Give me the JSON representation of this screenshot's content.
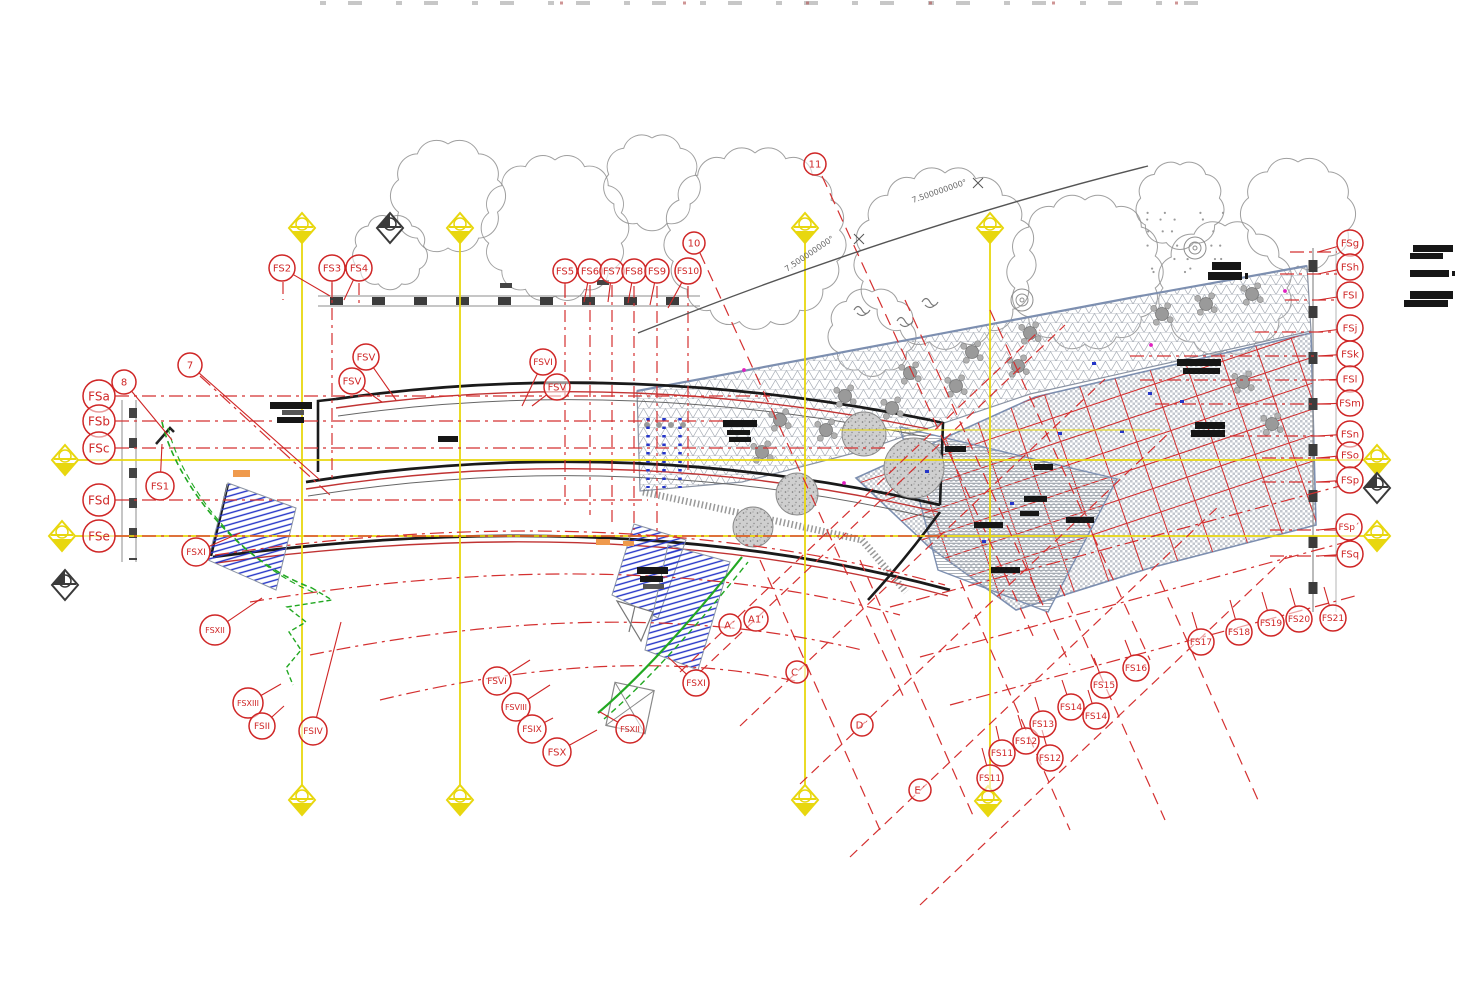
{
  "document": {
    "type_label": "architectural floor plan — grid and callout sheet"
  },
  "colors": {
    "red": "#d43030",
    "bubble": "#cf2626",
    "yellow": "#e8d70f",
    "yellow2": "#f5ea3a",
    "gray_line": "#8e8e8e",
    "green": "#22a822",
    "blue": "#2435c8",
    "orange": "#ef9a4d",
    "magenta": "#e020c0",
    "black": "#141414",
    "wall": "#1a1a1a"
  },
  "dimension_labels": [
    {
      "text": "7.500000000°",
      "x": 787,
      "y": 272,
      "rot": -34
    },
    {
      "text": "7.500000000°",
      "x": 913,
      "y": 203,
      "rot": -19
    }
  ],
  "callouts": [
    {
      "label": "FS2",
      "x": 282,
      "y": 268,
      "r": 13,
      "ax": 330,
      "ay": 296
    },
    {
      "label": "FS3",
      "x": 332,
      "y": 268,
      "r": 13,
      "ax": 332,
      "ay": 298
    },
    {
      "label": "FS4",
      "x": 359,
      "y": 268,
      "r": 13,
      "ax": 344,
      "ay": 300
    },
    {
      "label": "FS5",
      "x": 565,
      "y": 271,
      "r": 12,
      "ax": 565,
      "ay": 298
    },
    {
      "label": "FS6",
      "x": 590,
      "y": 271,
      "r": 12,
      "ax": 584,
      "ay": 302
    },
    {
      "label": "FS7",
      "x": 612,
      "y": 271,
      "r": 12,
      "ax": 608,
      "ay": 302
    },
    {
      "label": "FS8",
      "x": 634,
      "y": 271,
      "r": 12,
      "ax": 628,
      "ay": 303
    },
    {
      "label": "FS9",
      "x": 657,
      "y": 271,
      "r": 12,
      "ax": 650,
      "ay": 305
    },
    {
      "label": "FS10",
      "x": 688,
      "y": 271,
      "r": 13,
      "ax": 668,
      "ay": 308
    },
    {
      "label": "10",
      "x": 694,
      "y": 243,
      "r": 11
    },
    {
      "label": "11",
      "x": 815,
      "y": 164,
      "r": 11
    },
    {
      "label": "7",
      "x": 190,
      "y": 365,
      "r": 12,
      "ax": 320,
      "ay": 480
    },
    {
      "label": "8",
      "x": 124,
      "y": 382,
      "r": 12,
      "ax": 172,
      "ay": 440
    },
    {
      "label": "FSa",
      "x": 99,
      "y": 396,
      "r": 16,
      "ax": 115,
      "ay": 396
    },
    {
      "label": "FSb",
      "x": 99,
      "y": 421,
      "r": 16,
      "ax": 115,
      "ay": 421
    },
    {
      "label": "FSc",
      "x": 99,
      "y": 448,
      "r": 16,
      "ax": 115,
      "ay": 448
    },
    {
      "label": "FSd",
      "x": 99,
      "y": 500,
      "r": 16,
      "ax": 115,
      "ay": 500
    },
    {
      "label": "FSe",
      "x": 99,
      "y": 536,
      "r": 16,
      "ax": 115,
      "ay": 536
    },
    {
      "label": "FS1",
      "x": 160,
      "y": 486,
      "r": 14,
      "ax": 162,
      "ay": 444
    },
    {
      "label": "FSXI",
      "x": 196,
      "y": 552,
      "r": 14,
      "ax": 240,
      "ay": 533
    },
    {
      "label": "FSXII",
      "x": 215,
      "y": 630,
      "r": 15,
      "ax": 262,
      "ay": 598
    },
    {
      "label": "FSXIII",
      "x": 248,
      "y": 703,
      "r": 15,
      "ax": 281,
      "ay": 684
    },
    {
      "label": "FSII",
      "x": 262,
      "y": 726,
      "r": 13,
      "ax": 284,
      "ay": 706
    },
    {
      "label": "FSIV",
      "x": 313,
      "y": 731,
      "r": 14,
      "ax": 341,
      "ay": 622
    },
    {
      "label": "FSV",
      "x": 366,
      "y": 357,
      "r": 13,
      "ax": 396,
      "ay": 400
    },
    {
      "label": "FSV",
      "x": 352,
      "y": 381,
      "r": 13,
      "ax": 382,
      "ay": 402
    },
    {
      "label": "FSVI",
      "x": 543,
      "y": 362,
      "r": 13,
      "ax": 522,
      "ay": 406
    },
    {
      "label": "FSV",
      "x": 557,
      "y": 387,
      "r": 13,
      "ax": 532,
      "ay": 406
    },
    {
      "label": "FSVI",
      "x": 497,
      "y": 681,
      "r": 14,
      "ax": 530,
      "ay": 660
    },
    {
      "label": "FSVIII",
      "x": 516,
      "y": 707,
      "r": 14,
      "ax": 550,
      "ay": 685
    },
    {
      "label": "FSIX",
      "x": 532,
      "y": 729,
      "r": 14,
      "ax": 553,
      "ay": 718
    },
    {
      "label": "FSX",
      "x": 557,
      "y": 752,
      "r": 14,
      "ax": 597,
      "ay": 730
    },
    {
      "label": "FSXII",
      "x": 630,
      "y": 729,
      "r": 14,
      "ax": 600,
      "ay": 712
    },
    {
      "label": "FSXI",
      "x": 696,
      "y": 683,
      "r": 13,
      "ax": 668,
      "ay": 657
    },
    {
      "label": "FSg",
      "x": 1350,
      "y": 243,
      "r": 13,
      "ax": 1318,
      "ay": 252
    },
    {
      "label": "FSh",
      "x": 1350,
      "y": 267,
      "r": 13,
      "ax": 1318,
      "ay": 274
    },
    {
      "label": "FSI",
      "x": 1350,
      "y": 295,
      "r": 13,
      "ax": 1318,
      "ay": 300
    },
    {
      "label": "FSj",
      "x": 1350,
      "y": 328,
      "r": 13,
      "ax": 1318,
      "ay": 332
    },
    {
      "label": "FSk",
      "x": 1350,
      "y": 354,
      "r": 13,
      "ax": 1318,
      "ay": 356
    },
    {
      "label": "FSl",
      "x": 1350,
      "y": 379,
      "r": 13,
      "ax": 1318,
      "ay": 380
    },
    {
      "label": "FSm",
      "x": 1350,
      "y": 403,
      "r": 13,
      "ax": 1318,
      "ay": 404
    },
    {
      "label": "FSn",
      "x": 1350,
      "y": 434,
      "r": 13,
      "ax": 1318,
      "ay": 436
    },
    {
      "label": "FSo",
      "x": 1350,
      "y": 455,
      "r": 13,
      "ax": 1318,
      "ay": 458
    },
    {
      "label": "FSp",
      "x": 1350,
      "y": 480,
      "r": 13,
      "ax": 1318,
      "ay": 482
    },
    {
      "label": "FSp´",
      "x": 1349,
      "y": 527,
      "r": 13,
      "ax": 1318,
      "ay": 530
    },
    {
      "label": "FSq",
      "x": 1350,
      "y": 554,
      "r": 13,
      "ax": 1318,
      "ay": 556
    },
    {
      "label": "FS11",
      "x": 990,
      "y": 778,
      "r": 13,
      "ax": 982,
      "ay": 748
    },
    {
      "label": "FS11",
      "x": 1002,
      "y": 753,
      "r": 13,
      "ax": 996,
      "ay": 726
    },
    {
      "label": "FS12",
      "x": 1026,
      "y": 741,
      "r": 13,
      "ax": 1018,
      "ay": 715
    },
    {
      "label": "FS12",
      "x": 1050,
      "y": 758,
      "r": 13,
      "ax": 1042,
      "ay": 730
    },
    {
      "label": "FS13",
      "x": 1043,
      "y": 724,
      "r": 13,
      "ax": 1035,
      "ay": 697
    },
    {
      "label": "FS14",
      "x": 1071,
      "y": 707,
      "r": 13,
      "ax": 1062,
      "ay": 680
    },
    {
      "label": "FS14",
      "x": 1096,
      "y": 716,
      "r": 13,
      "ax": 1088,
      "ay": 690
    },
    {
      "label": "FS15",
      "x": 1104,
      "y": 685,
      "r": 13,
      "ax": 1094,
      "ay": 658
    },
    {
      "label": "FS16",
      "x": 1136,
      "y": 668,
      "r": 13,
      "ax": 1125,
      "ay": 640
    },
    {
      "label": "FS17",
      "x": 1201,
      "y": 642,
      "r": 13,
      "ax": 1192,
      "ay": 612
    },
    {
      "label": "FS18",
      "x": 1239,
      "y": 632,
      "r": 13,
      "ax": 1230,
      "ay": 600
    },
    {
      "label": "FS19",
      "x": 1271,
      "y": 623,
      "r": 13,
      "ax": 1262,
      "ay": 592
    },
    {
      "label": "FS20",
      "x": 1299,
      "y": 619,
      "r": 13,
      "ax": 1290,
      "ay": 588
    },
    {
      "label": "FS21",
      "x": 1333,
      "y": 618,
      "r": 13,
      "ax": 1324,
      "ay": 587
    },
    {
      "label": "A´",
      "x": 730,
      "y": 625,
      "r": 11
    },
    {
      "label": "A1'",
      "x": 756,
      "y": 619,
      "r": 12
    },
    {
      "label": "C´",
      "x": 797,
      "y": 672,
      "r": 11
    },
    {
      "label": "D´",
      "x": 862,
      "y": 725,
      "r": 11
    },
    {
      "label": "E´",
      "x": 920,
      "y": 790,
      "r": 11
    }
  ],
  "grid": {
    "yellow_vertical": [
      {
        "x": 302,
        "y1": 228,
        "y2": 800
      },
      {
        "x": 460,
        "y1": 228,
        "y2": 800
      },
      {
        "x": 805,
        "y1": 228,
        "y2": 800
      },
      {
        "x": 990,
        "y1": 228,
        "y2": 801
      }
    ],
    "yellow_horizontal": [
      {
        "y": 460,
        "x1": 65,
        "x2": 1377
      },
      {
        "y": 536,
        "x1": 62,
        "x2": 1377
      }
    ],
    "partial_horizontal": {
      "y": 430,
      "x1": 840,
      "x2": 1160
    },
    "markers_yellow": [
      [
        302,
        228
      ],
      [
        460,
        228
      ],
      [
        805,
        228
      ],
      [
        990,
        228
      ],
      [
        302,
        800
      ],
      [
        460,
        800
      ],
      [
        805,
        800
      ],
      [
        988,
        801
      ],
      [
        65,
        460
      ],
      [
        62,
        536
      ],
      [
        1377,
        460
      ],
      [
        1377,
        536
      ]
    ],
    "markers_gray": [
      [
        390,
        228
      ],
      [
        65,
        585
      ],
      [
        1377,
        488
      ]
    ]
  },
  "red_rows": [
    {
      "y": 396,
      "x1": 115,
      "x2": 770
    },
    {
      "y": 421,
      "x1": 115,
      "x2": 755
    },
    {
      "y": 448,
      "x1": 115,
      "x2": 888
    },
    {
      "y": 500,
      "x1": 115,
      "x2": 648
    },
    {
      "y": 536,
      "x1": 115,
      "x2": 952
    },
    {
      "y": 252,
      "x1": 1290,
      "x2": 1337
    },
    {
      "y": 274,
      "x1": 1280,
      "x2": 1337
    },
    {
      "y": 300,
      "x1": 1285,
      "x2": 1337
    },
    {
      "y": 332,
      "x1": 1255,
      "x2": 1337
    },
    {
      "y": 356,
      "x1": 1130,
      "x2": 1337
    },
    {
      "y": 380,
      "x1": 1140,
      "x2": 1337
    },
    {
      "y": 404,
      "x1": 1155,
      "x2": 1337
    },
    {
      "y": 436,
      "x1": 1230,
      "x2": 1337
    },
    {
      "y": 458,
      "x1": 1262,
      "x2": 1337
    },
    {
      "y": 482,
      "x1": 1262,
      "x2": 1337
    },
    {
      "y": 530,
      "x1": 1270,
      "x2": 1336
    },
    {
      "y": 556,
      "x1": 1270,
      "x2": 1336
    }
  ],
  "red_cols": [
    {
      "x": 283,
      "y1": 282,
      "y2": 300
    },
    {
      "x": 332,
      "y1": 283,
      "y2": 478
    },
    {
      "x": 359,
      "y1": 283,
      "y2": 308
    },
    {
      "x": 565,
      "y1": 285,
      "y2": 505
    },
    {
      "x": 590,
      "y1": 285,
      "y2": 515
    },
    {
      "x": 612,
      "y1": 285,
      "y2": 522
    },
    {
      "x": 634,
      "y1": 286,
      "y2": 530
    },
    {
      "x": 657,
      "y1": 286,
      "y2": 540
    },
    {
      "x": 688,
      "y1": 286,
      "y2": 470
    }
  ],
  "redacted_blocks": [
    {
      "x": 1413,
      "y": 245,
      "w": 40,
      "h": 7
    },
    {
      "x": 1410,
      "y": 253,
      "w": 33,
      "h": 6
    },
    {
      "x": 1410,
      "y": 270,
      "w": 39,
      "h": 7
    },
    {
      "x": 1452,
      "y": 271,
      "w": 3,
      "h": 5
    },
    {
      "x": 1410,
      "y": 291,
      "w": 43,
      "h": 8
    },
    {
      "x": 1404,
      "y": 300,
      "w": 44,
      "h": 7
    },
    {
      "x": 1212,
      "y": 262,
      "w": 29,
      "h": 8
    },
    {
      "x": 1208,
      "y": 272,
      "w": 34,
      "h": 8
    },
    {
      "x": 1245,
      "y": 273,
      "w": 3,
      "h": 6
    },
    {
      "x": 723,
      "y": 420,
      "w": 34,
      "h": 7
    },
    {
      "x": 727,
      "y": 430,
      "w": 23,
      "h": 5
    },
    {
      "x": 729,
      "y": 437,
      "w": 22,
      "h": 5
    },
    {
      "x": 1177,
      "y": 359,
      "w": 44,
      "h": 7
    },
    {
      "x": 1183,
      "y": 368,
      "w": 37,
      "h": 6
    },
    {
      "x": 1195,
      "y": 422,
      "w": 30,
      "h": 7
    },
    {
      "x": 1191,
      "y": 430,
      "w": 34,
      "h": 7
    },
    {
      "x": 945,
      "y": 446,
      "w": 21,
      "h": 6
    },
    {
      "x": 1034,
      "y": 464,
      "w": 19,
      "h": 6
    },
    {
      "x": 1024,
      "y": 496,
      "w": 23,
      "h": 6
    },
    {
      "x": 1020,
      "y": 511,
      "w": 19,
      "h": 5
    },
    {
      "x": 1066,
      "y": 517,
      "w": 28,
      "h": 6
    },
    {
      "x": 974,
      "y": 522,
      "w": 29,
      "h": 6
    },
    {
      "x": 991,
      "y": 567,
      "w": 29,
      "h": 6
    },
    {
      "x": 270,
      "y": 402,
      "w": 42,
      "h": 7
    },
    {
      "x": 282,
      "y": 410,
      "w": 22,
      "h": 5,
      "shade": "#555"
    },
    {
      "x": 277,
      "y": 417,
      "w": 27,
      "h": 6
    },
    {
      "x": 438,
      "y": 436,
      "w": 20,
      "h": 6
    },
    {
      "x": 637,
      "y": 567,
      "w": 31,
      "h": 7
    },
    {
      "x": 640,
      "y": 576,
      "w": 23,
      "h": 6
    },
    {
      "x": 643,
      "y": 584,
      "w": 21,
      "h": 5,
      "shade": "#555"
    },
    {
      "x": 500,
      "y": 283,
      "w": 12,
      "h": 5,
      "shade": "#444"
    },
    {
      "x": 597,
      "y": 280,
      "w": 12,
      "h": 5,
      "shade": "#444"
    }
  ],
  "orange_marks": [
    {
      "x": 233,
      "y": 470,
      "w": 17,
      "h": 7
    },
    {
      "x": 596,
      "y": 539,
      "w": 14,
      "h": 6
    },
    {
      "x": 623,
      "y": 541,
      "w": 11,
      "h": 5
    }
  ],
  "magenta_dots": [
    [
      744,
      370
    ],
    [
      844,
      483
    ],
    [
      1151,
      345
    ],
    [
      1285,
      291
    ]
  ],
  "trees": [
    {
      "x": 555,
      "y": 228,
      "r": 68
    },
    {
      "x": 755,
      "y": 238,
      "r": 85
    },
    {
      "x": 945,
      "y": 258,
      "r": 85
    },
    {
      "x": 1085,
      "y": 272,
      "r": 72
    },
    {
      "x": 1225,
      "y": 288,
      "r": 62
    },
    {
      "x": 1298,
      "y": 214,
      "r": 52
    },
    {
      "x": 448,
      "y": 196,
      "r": 52
    },
    {
      "x": 652,
      "y": 182,
      "r": 44
    },
    {
      "x": 872,
      "y": 332,
      "r": 40
    },
    {
      "x": 1180,
      "y": 205,
      "r": 40
    },
    {
      "x": 390,
      "y": 252,
      "r": 34
    }
  ],
  "furniture_tables": [
    [
      780,
      420
    ],
    [
      845,
      396
    ],
    [
      910,
      373
    ],
    [
      972,
      352
    ],
    [
      1030,
      333
    ],
    [
      762,
      452
    ],
    [
      826,
      430
    ],
    [
      892,
      408
    ],
    [
      956,
      386
    ],
    [
      1018,
      366
    ],
    [
      1162,
      314
    ],
    [
      1206,
      304
    ],
    [
      1252,
      294
    ],
    [
      1243,
      382
    ],
    [
      1272,
      424
    ]
  ],
  "planters": [
    {
      "x": 753,
      "y": 527,
      "r": 20
    },
    {
      "x": 797,
      "y": 494,
      "r": 21
    },
    {
      "x": 864,
      "y": 434,
      "r": 22
    },
    {
      "x": 914,
      "y": 468,
      "r": 30
    }
  ],
  "terrace_poly": [
    [
      637,
      391
    ],
    [
      1135,
      297
    ],
    [
      1307,
      266
    ],
    [
      1311,
      331
    ],
    [
      1030,
      394
    ],
    [
      858,
      452
    ],
    [
      742,
      482
    ],
    [
      640,
      491
    ]
  ],
  "right_building_poly": [
    [
      856,
      478
    ],
    [
      1035,
      397
    ],
    [
      1311,
      333
    ],
    [
      1316,
      525
    ],
    [
      1150,
      568
    ],
    [
      1016,
      610
    ],
    [
      928,
      546
    ]
  ],
  "lower_building_poly": [
    [
      900,
      427
    ],
    [
      1117,
      479
    ],
    [
      1048,
      612
    ],
    [
      938,
      570
    ]
  ],
  "stair_polys": [
    [
      [
        228,
        483
      ],
      [
        296,
        508
      ],
      [
        276,
        590
      ],
      [
        208,
        560
      ]
    ],
    [
      [
        634,
        524
      ],
      [
        686,
        540
      ],
      [
        658,
        618
      ],
      [
        612,
        595
      ]
    ],
    [
      [
        668,
        545
      ],
      [
        730,
        562
      ],
      [
        698,
        670
      ],
      [
        645,
        650
      ]
    ]
  ]
}
